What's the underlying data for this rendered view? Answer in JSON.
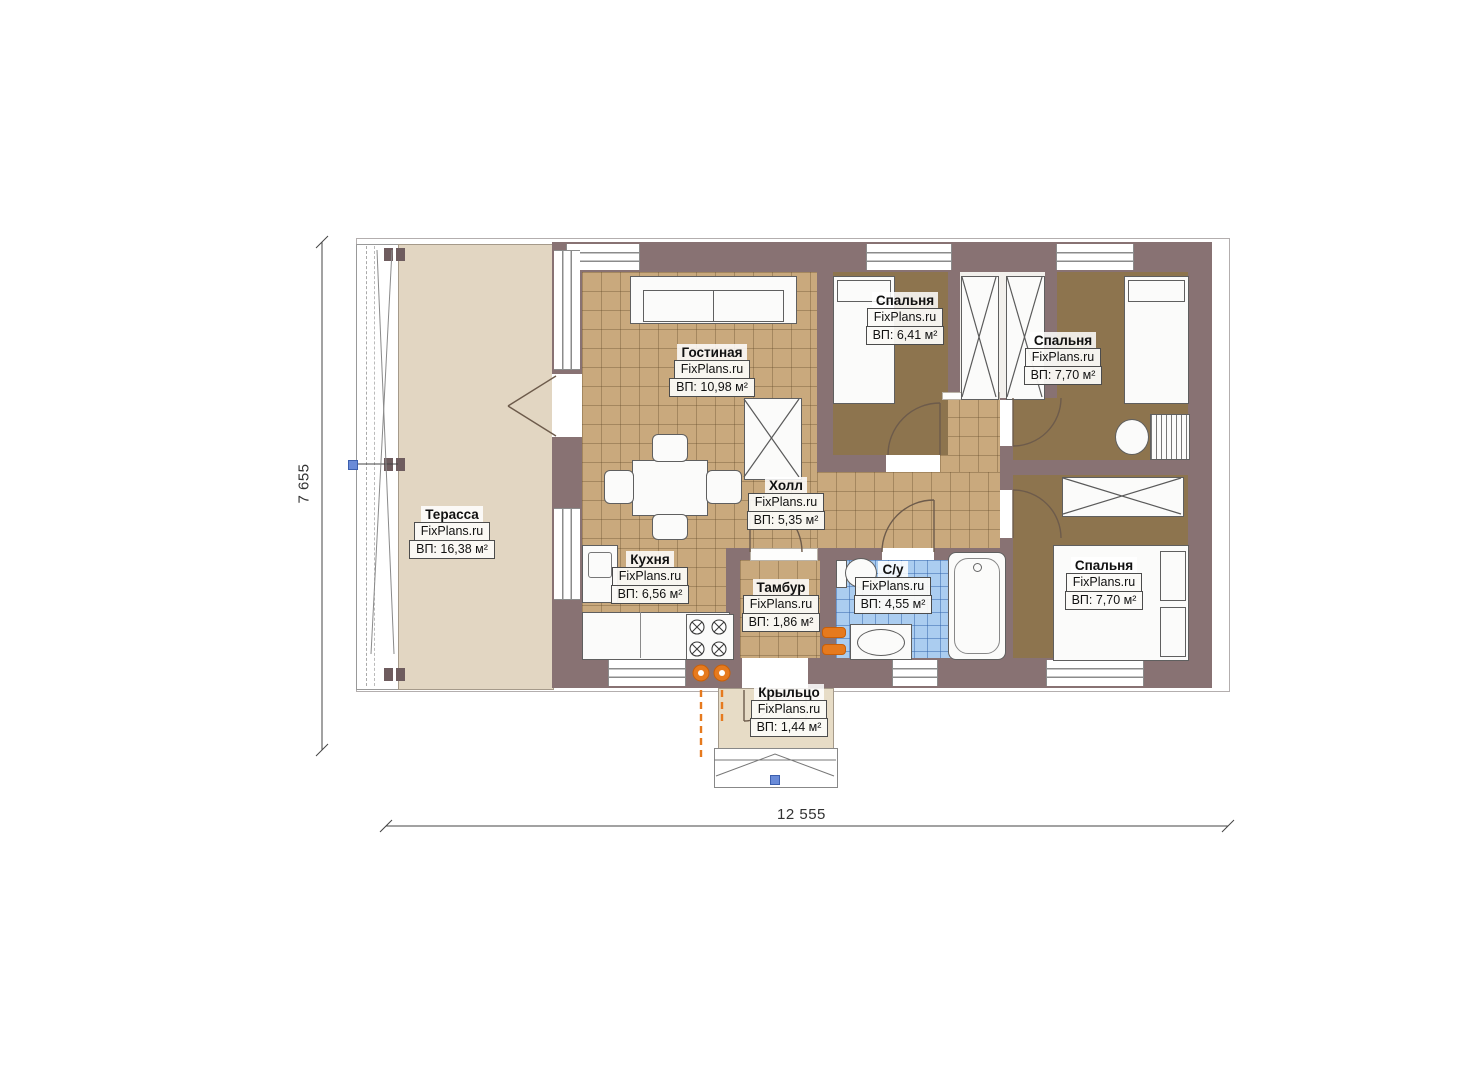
{
  "plan": {
    "watermark": "FixPlans.ru",
    "dimensions": {
      "horizontal": "12 555",
      "vertical": "7 655"
    },
    "rooms": [
      {
        "key": "terrace",
        "name": "Терасса",
        "area": "ВП: 16,38 м²"
      },
      {
        "key": "living-room",
        "name": "Гостиная",
        "area": "ВП: 10,98 м²"
      },
      {
        "key": "bedroom-top",
        "name": "Спальня",
        "area": "ВП: 6,41 м²"
      },
      {
        "key": "bedroom-right",
        "name": "Спальня",
        "area": "ВП: 7,70 м²"
      },
      {
        "key": "hall",
        "name": "Холл",
        "area": "ВП: 5,35 м²"
      },
      {
        "key": "kitchen",
        "name": "Кухня",
        "area": "ВП: 6,56 м²"
      },
      {
        "key": "tambour",
        "name": "Тамбур",
        "area": "ВП: 1,86 м²"
      },
      {
        "key": "bathroom",
        "name": "С/у",
        "area": "ВП: 4,55 м²"
      },
      {
        "key": "bedroom-bottom",
        "name": "Спальня",
        "area": "ВП: 7,70 м²"
      },
      {
        "key": "porch",
        "name": "Крыльцо",
        "area": "ВП: 1,44 м²"
      }
    ],
    "colors": {
      "wall": "#887273",
      "tile_floor": "#c9a97d",
      "bedroom_floor": "#8d744e",
      "terrace_floor": "#e2d6c2",
      "porch_floor": "#e7dcc6",
      "bathroom_tile": "#abcdf0",
      "accent_orange": "#e67a1e",
      "marker_blue": "#6a8bd8"
    }
  }
}
